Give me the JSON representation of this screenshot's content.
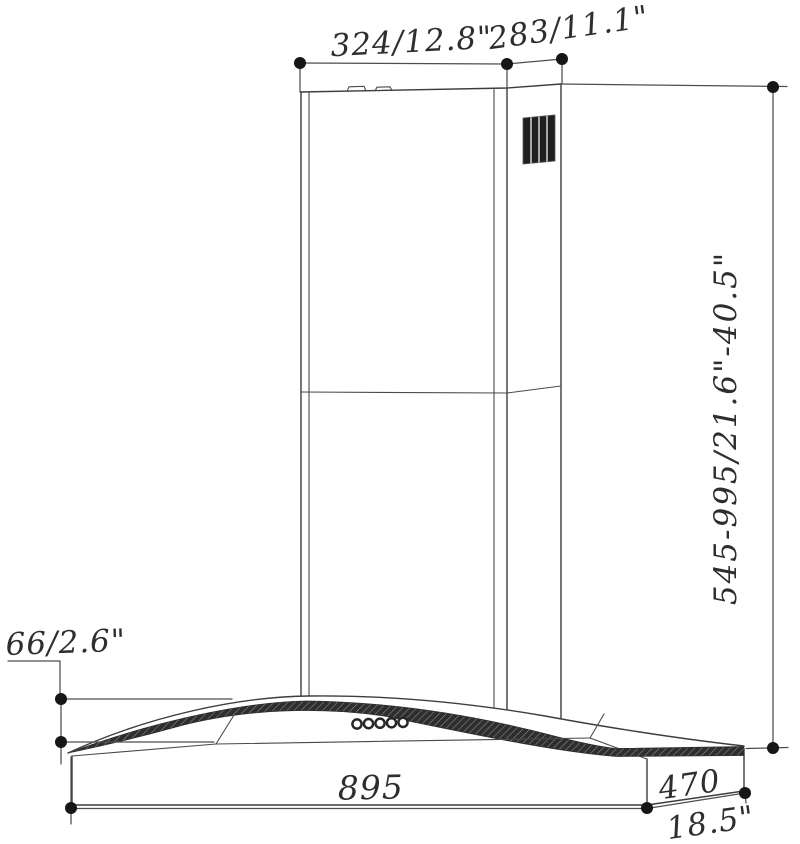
{
  "drawing": {
    "title": "Wall-mount curved-glass range hood dimension drawing",
    "labels": {
      "chimney_width": "324/12.8\"",
      "chimney_depth": "283/11.1\"",
      "mount_height_range": "545-995/21.6\"-40.5\"",
      "body_height": "66/2.6\"",
      "body_width_mm": "895",
      "body_depth_mm": "470",
      "body_depth_inch": "18.5\""
    },
    "colors": {
      "line": "#3d3d3d",
      "dimension_line": "#4e4e4e",
      "endpoint_dot": "#161616",
      "grille_dark": "#1f1f1f",
      "glass_band": "#2e2e2e",
      "background": "#ffffff"
    },
    "features": {
      "vent_grille_slats": 4,
      "control_buttons": 5
    }
  }
}
